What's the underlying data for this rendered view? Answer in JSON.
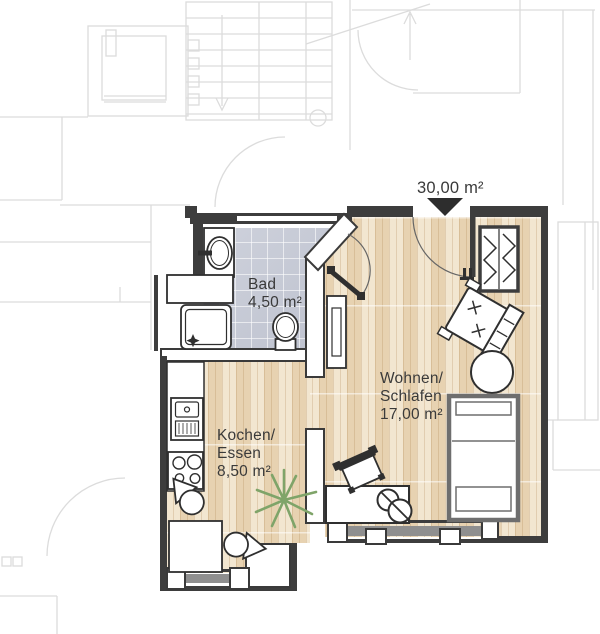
{
  "floorplan": {
    "total_area_label": "30,00 m²",
    "rooms": {
      "bad": {
        "name": "Bad",
        "area": "4,50 m²"
      },
      "kochen": {
        "line1": "Kochen/",
        "line2": "Essen",
        "area": "8,50 m²"
      },
      "wohnen": {
        "line1": "Wohnen/",
        "line2": "Schlafen",
        "area": "17,00 m²"
      }
    },
    "fixtures": [
      "washbasin",
      "shower",
      "toilet",
      "radiator",
      "wardrobe",
      "armchair",
      "round-table",
      "bed",
      "desk",
      "desk-chair",
      "dining-table",
      "dining-chair",
      "kitchen-sink",
      "stove",
      "plant",
      "entrance-marker",
      "entrance-door",
      "bath-door"
    ],
    "colors": {
      "exterior_wall": "#3d3d3d",
      "interior_wall": "#ffffff",
      "wood_floor": "#efdfc3",
      "tile_floor": "#c6cad6",
      "window_sill": "#8f8f8f",
      "bed_frame": "#6e6e6e",
      "plant_green": "#7fa469",
      "label_text": "#3a3a3a",
      "background_linework": "#dcdcdc"
    }
  }
}
